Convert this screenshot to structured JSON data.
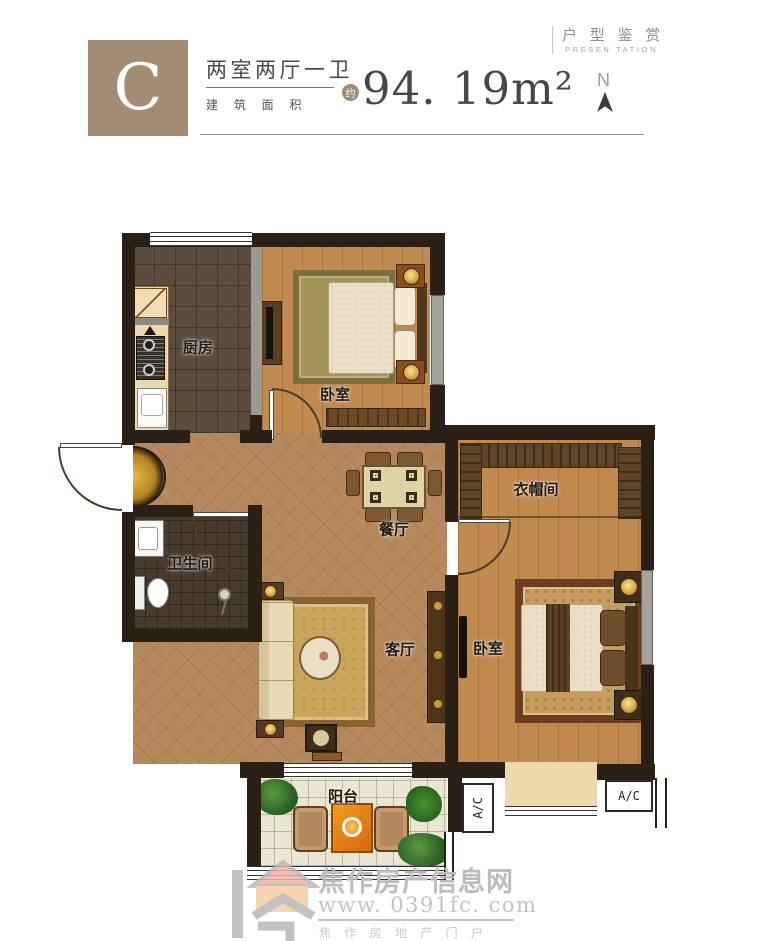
{
  "header": {
    "unit_label": "C",
    "layout_title": "两室两厅一卫",
    "area_caption": "建 筑 面 积",
    "approx_badge": "约",
    "area_value": "94. 19m²",
    "series_title": "户 型 鉴 赏",
    "series_subtitle": "PRESEN TATION",
    "compass_label": "N"
  },
  "rooms": {
    "kitchen": "厨房",
    "bedroom_top": "卧室",
    "bathroom": "卫生间",
    "dining": "餐厅",
    "cloakroom": "衣帽间",
    "living": "客厅",
    "bedroom_right": "卧室",
    "balcony": "阳台",
    "ac_left": "A/C",
    "ac_right": "A/C"
  },
  "watermark": {
    "site_name": "焦作房产信息网",
    "site_url": "www. 0391fc. com",
    "site_slogan": "焦 作 房 地 产 门 户"
  },
  "colors": {
    "brand_tan": "#a28c74",
    "wall": "#2b2015",
    "wood_floor": "#c18a4f",
    "tile_floor": "#b68a5c",
    "kitchen_floor": "#5c4c3e",
    "bathroom_floor": "#493b2d",
    "balcony_floor": "#ebe6d3",
    "watermark_gray": "#bdbcbc",
    "accent_orange": "#e07f10"
  }
}
